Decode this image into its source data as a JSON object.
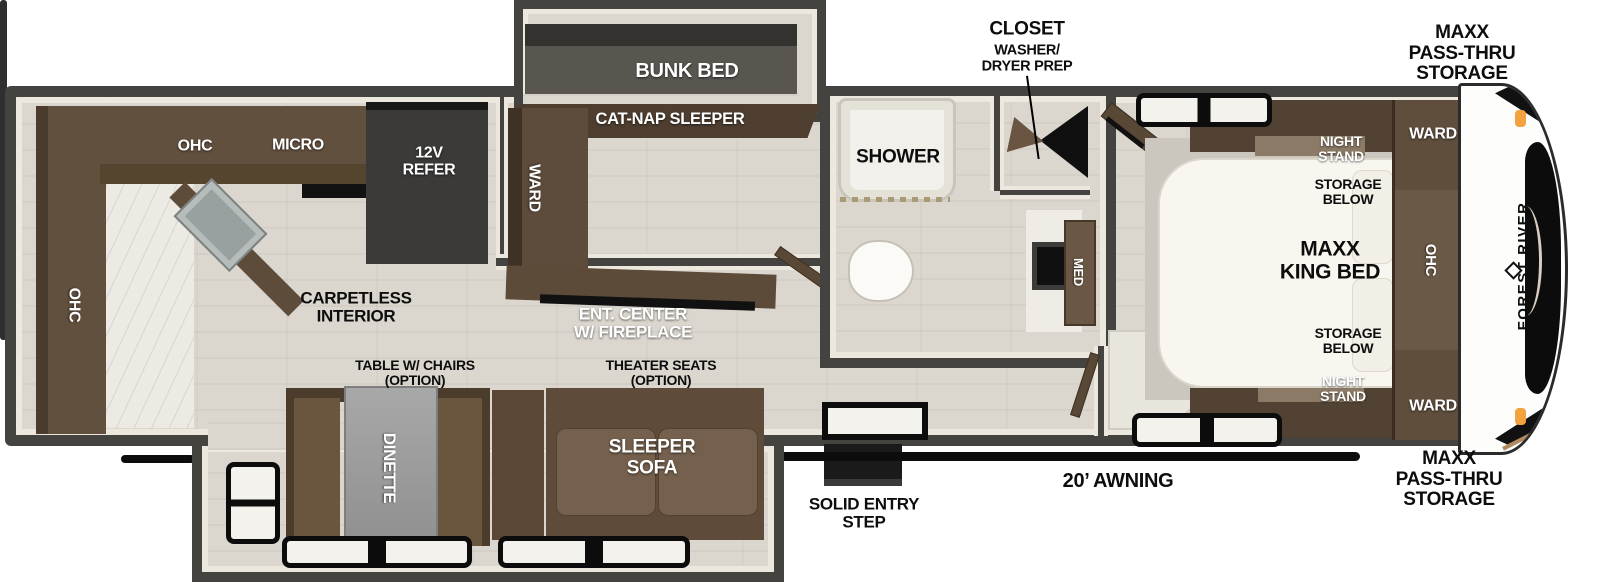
{
  "colors": {
    "wall": "#454340",
    "trim": "#ece8dd",
    "floor": "#dbd7cf",
    "cabinet_brown": "#63503e",
    "dark_brown": "#4c3c2b",
    "mattress_white": "#f8f6ef",
    "bunk_mattress_gray": "#595650",
    "table_gray": "#9c9c9c",
    "awning_black": "#0c0c0c",
    "marker_orange": "#f2a23e",
    "accent_tan": "#b08960"
  },
  "labels": {
    "storage_front_top": "MAXX\nPASS-THRU\nSTORAGE",
    "closet_title": "CLOSET",
    "closet_sub": "WASHER/\nDRYER PREP",
    "bunk_bed": "BUNK BED",
    "cat_nap_sleeper": "CAT-NAP SLEEPER",
    "bunk_ward": "WARD",
    "shower": "SHOWER",
    "med_cabinet": "MED",
    "night_stand_top": "NIGHT\nSTAND",
    "storage_below_top": "STORAGE\nBELOW",
    "king_bed": "MAXX\nKING BED",
    "storage_below_bottom": "STORAGE\nBELOW",
    "night_stand_bottom": "NIGHT\nSTAND",
    "ward_front_top": "WARD",
    "bedroom_ohc": "OHC",
    "ward_front_bottom": "WARD",
    "brand": "FOREST RIVER",
    "kitchen_ohc": "OHC",
    "micro": "MICRO",
    "refer": "12V\nREFER",
    "rear_ohc": "OHC",
    "carpetless": "CARPETLESS\nINTERIOR",
    "ent_center": "ENT. CENTER\nW/ FIREPLACE",
    "table_option": "TABLE W/ CHAIRS\n(OPTION)",
    "theater_option": "THEATER SEATS\n(OPTION)",
    "dinette": "DINETTE",
    "sleeper_sofa": "SLEEPER\nSOFA",
    "entry_step": "SOLID ENTRY\nSTEP",
    "awning": "20’ AWNING",
    "storage_front_bottom": "MAXX\nPASS-THRU\nSTORAGE"
  }
}
